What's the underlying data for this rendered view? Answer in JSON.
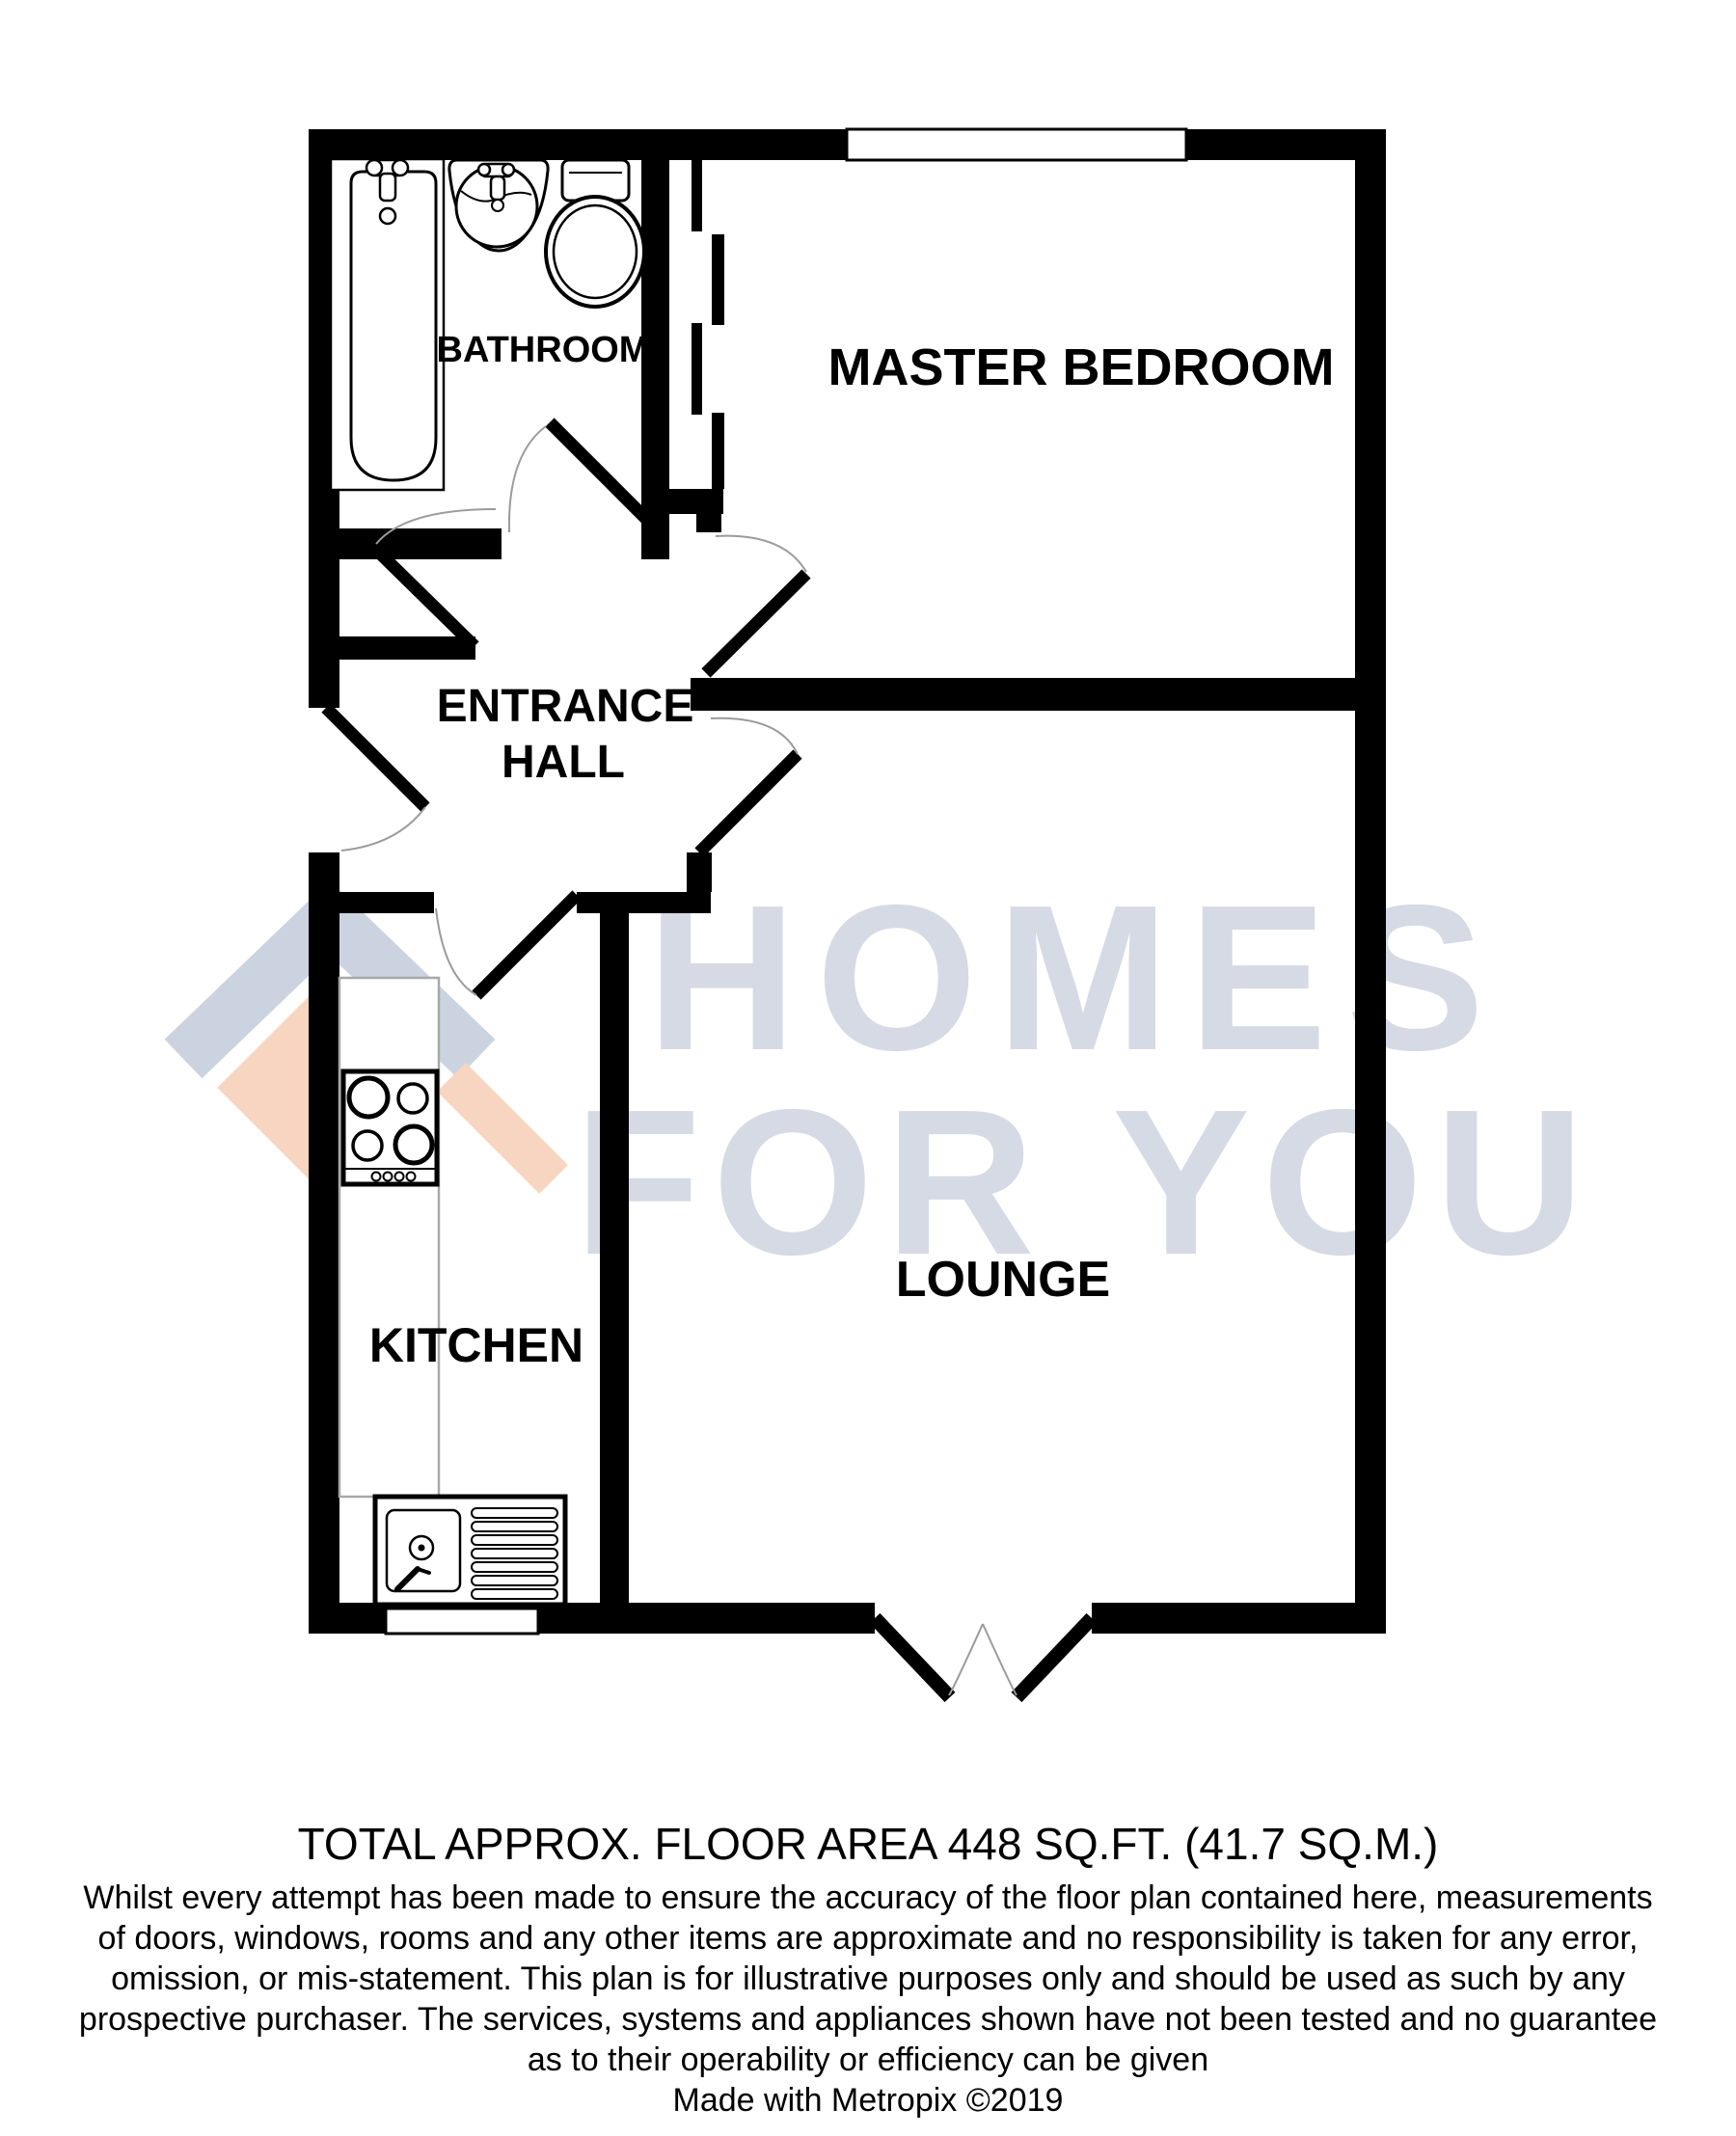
{
  "plan": {
    "rooms": {
      "bathroom": "BATHROOM",
      "master_bedroom": "MASTER BEDROOM",
      "entrance_hall_line1": "ENTRANCE",
      "entrance_hall_line2": "HALL",
      "kitchen": "KITCHEN",
      "lounge": "LOUNGE"
    },
    "fixtures": [
      "bath",
      "basin-sink",
      "toilet",
      "hob",
      "kitchen-sink-drainer",
      "worktop-counter"
    ],
    "openings": [
      "bathroom-door",
      "front-entrance-door",
      "master-bedroom-door",
      "kitchen-door",
      "lounge-door",
      "patio-double-door",
      "bedroom-window",
      "top-window",
      "kitchen-window"
    ]
  },
  "watermark": {
    "line1": "HOMES",
    "line2": "FOR YOU",
    "text_color": "#d5dae4",
    "logo_roof_color": "#cbd3e0",
    "logo_diamond_color": "#f8d5c0"
  },
  "footer": {
    "area_title": "TOTAL APPROX. FLOOR AREA 448 SQ.FT. (41.7 SQ.M.)",
    "area_sqft": "448",
    "area_sqm": "41.7",
    "disclaimer_lines": [
      "Whilst every attempt has been made to ensure the accuracy of the floor plan contained here, measurements",
      "of doors, windows, rooms and any other items are approximate and no responsibility is taken for any error,",
      "omission, or mis-statement. This plan is for illustrative purposes only and should be used as such by any",
      "prospective purchaser. The services, systems and appliances shown have not been tested and no guarantee",
      "as to their operability or efficiency can be given"
    ],
    "credit": "Made with Metropix ©2019"
  },
  "colors": {
    "wall": "#000000",
    "door_arc": "#9b9b9b",
    "counter_outline": "#a8a8a8",
    "background": "#ffffff"
  }
}
